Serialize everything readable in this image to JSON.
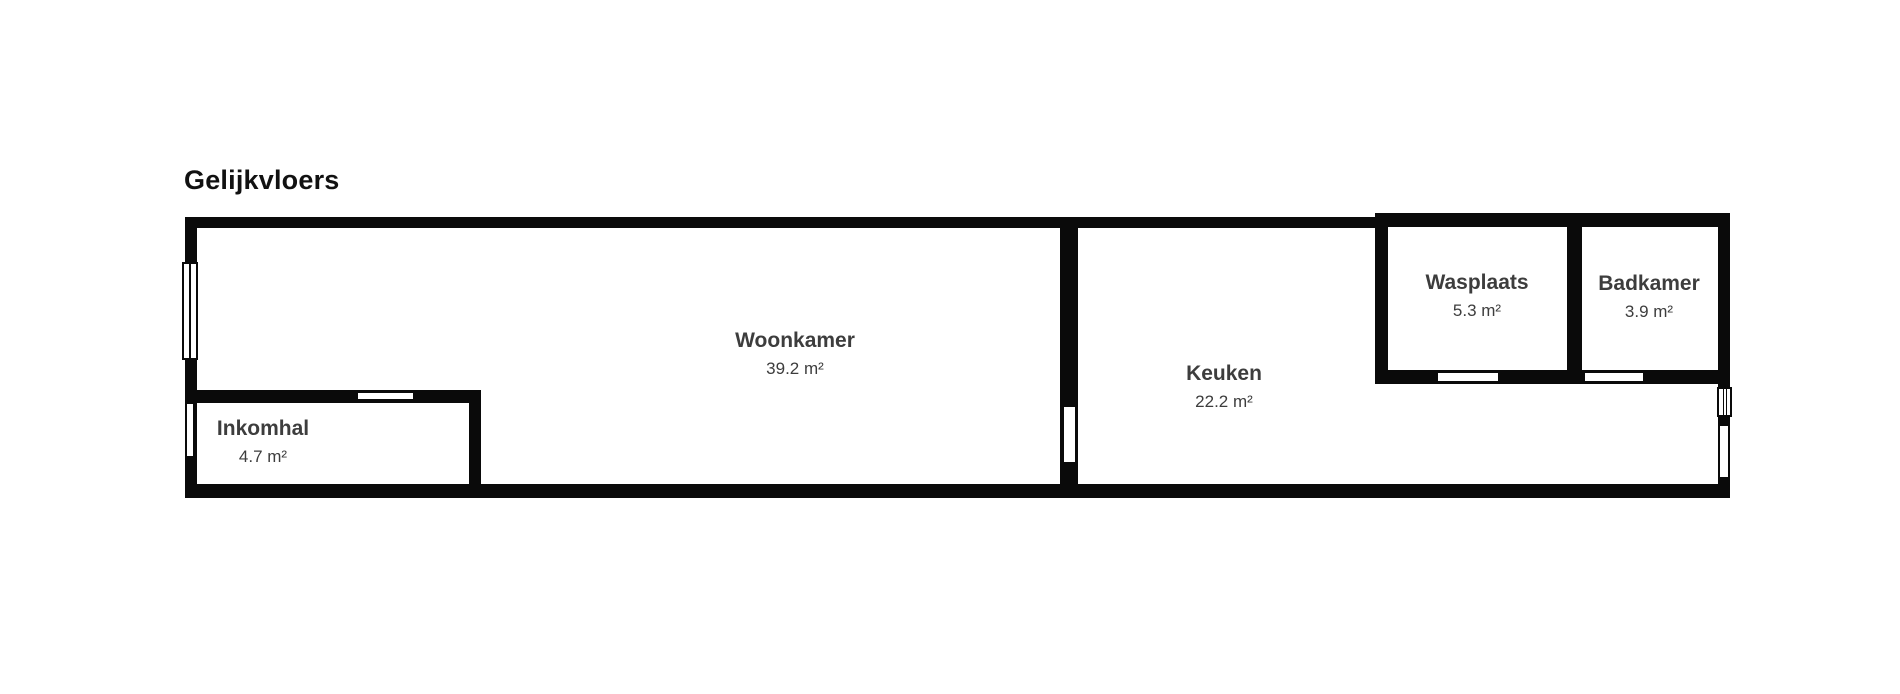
{
  "title": "Gelijkvloers",
  "rooms": [
    {
      "name": "Woonkamer",
      "area": "39.2 m²"
    },
    {
      "name": "Inkomhal",
      "area": "4.7 m²"
    },
    {
      "name": "Keuken",
      "area": "22.2 m²"
    },
    {
      "name": "Wasplaats",
      "area": "5.3 m²"
    },
    {
      "name": "Badkamer",
      "area": "3.9 m²"
    }
  ],
  "colors": {
    "wall": "#0a0a0a",
    "label": "#3d3d3d",
    "title": "#111111",
    "background": "#ffffff"
  }
}
